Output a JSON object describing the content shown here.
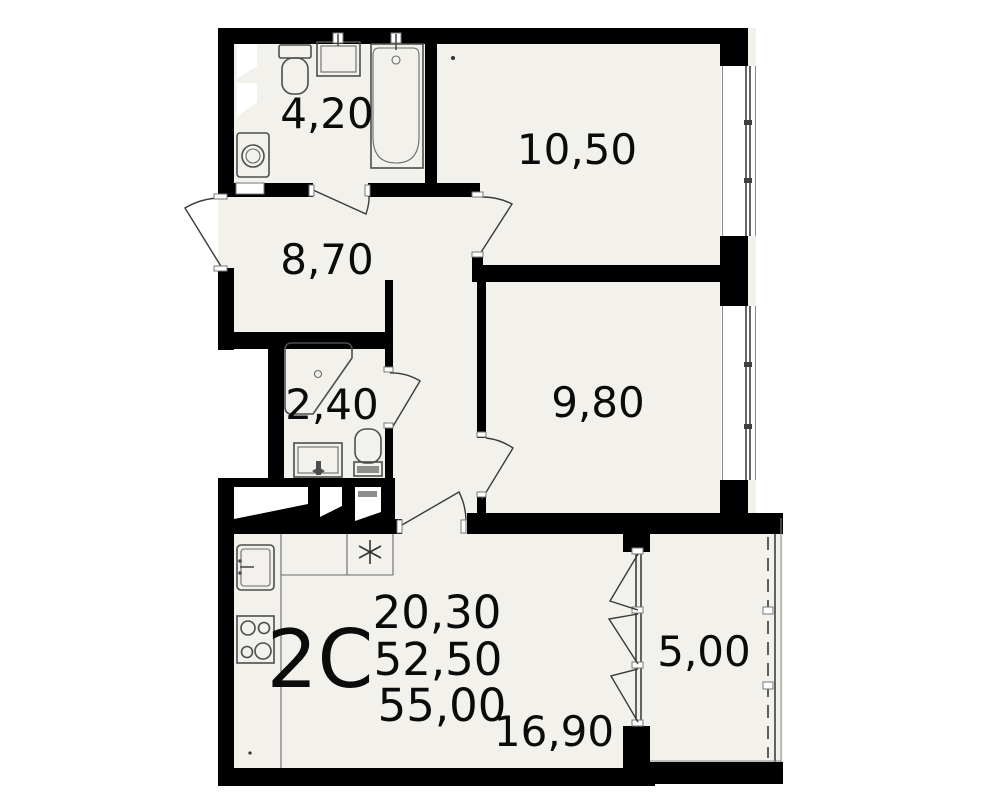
{
  "plan": {
    "title": "2-room apartment floor plan",
    "unit": {
      "type_label": "2C",
      "living_area": "20,30",
      "area_without_balcony": "52,50",
      "total_area": "55,00"
    },
    "rooms": [
      {
        "name": "bathroom",
        "area": "4,20"
      },
      {
        "name": "room-1",
        "area": "10,50"
      },
      {
        "name": "hallway",
        "area": "8,70"
      },
      {
        "name": "shower-room",
        "area": "2,40"
      },
      {
        "name": "room-2",
        "area": "9,80"
      },
      {
        "name": "kitchen-living-room",
        "area": "16,90"
      },
      {
        "name": "balcony",
        "area": "5,00"
      }
    ],
    "fixtures": [
      "toilet",
      "wash-basin",
      "bathtub",
      "washing-machine",
      "shower-cabin",
      "kitchen-sink",
      "stove",
      "refrigerator-spot-asterisk",
      "ventilation-shaft"
    ],
    "colors": {
      "wall": "#000000",
      "floor": "#f2f1ec",
      "fixture_line": "#4d4d4d",
      "background": "#ffffff"
    }
  }
}
